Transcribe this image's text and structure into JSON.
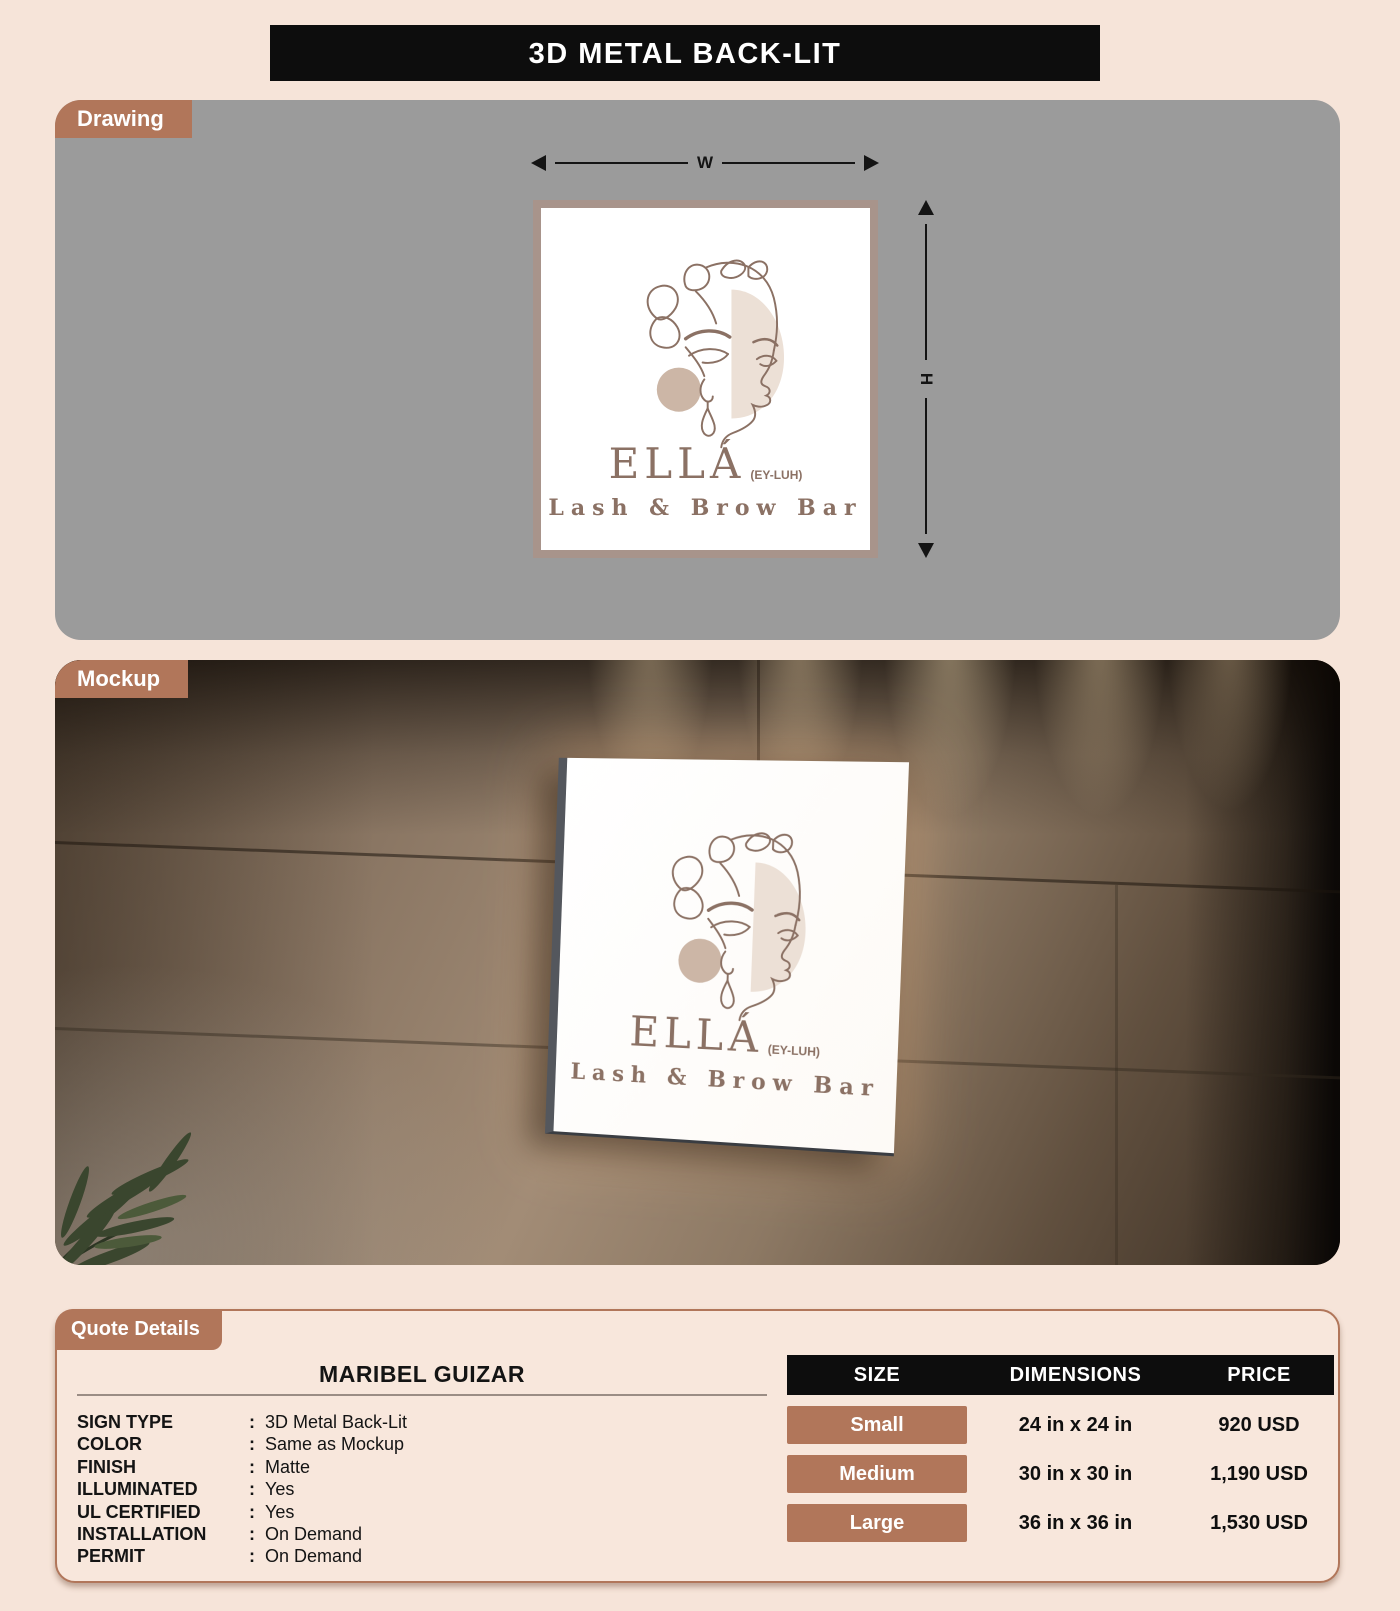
{
  "title": "3D METAL BACK-LIT",
  "sections": {
    "drawing_label": "Drawing",
    "mockup_label": "Mockup",
    "quote_label": "Quote Details"
  },
  "dimensions": {
    "width_label": "W",
    "height_label": "H"
  },
  "sign": {
    "brand": "ELLÁ",
    "pronunciation": "(EY-LUH)",
    "tagline": "Lash & Brow Bar"
  },
  "quote": {
    "customer": "MARIBEL GUIZAR",
    "colon": ":",
    "specs": [
      {
        "label": "SIGN TYPE",
        "value": "3D Metal Back-Lit"
      },
      {
        "label": "COLOR",
        "value": "Same as Mockup"
      },
      {
        "label": "FINISH",
        "value": "Matte"
      },
      {
        "label": "ILLUMINATED",
        "value": "Yes"
      },
      {
        "label": "UL CERTIFIED",
        "value": "Yes"
      },
      {
        "label": "INSTALLATION",
        "value": "On Demand"
      },
      {
        "label": "PERMIT",
        "value": "On Demand"
      }
    ],
    "table": {
      "headers": [
        "SIZE",
        "DIMENSIONS",
        "PRICE"
      ],
      "rows": [
        {
          "size": "Small",
          "dimensions": "24 in x 24 in",
          "price": "920 USD"
        },
        {
          "size": "Medium",
          "dimensions": "30 in x 30 in",
          "price": "1,190 USD"
        },
        {
          "size": "Large",
          "dimensions": "36 in x 36 in",
          "price": "1,530 USD"
        }
      ]
    }
  },
  "colors": {
    "accent_terracotta": "#b1765a",
    "header_black": "#0d0d0d",
    "page_background": "#f6e4d9",
    "drawing_panel_gray": "#9b9b9b",
    "sign_frame": "#a8948b",
    "logo_brown": "#8b7164"
  }
}
